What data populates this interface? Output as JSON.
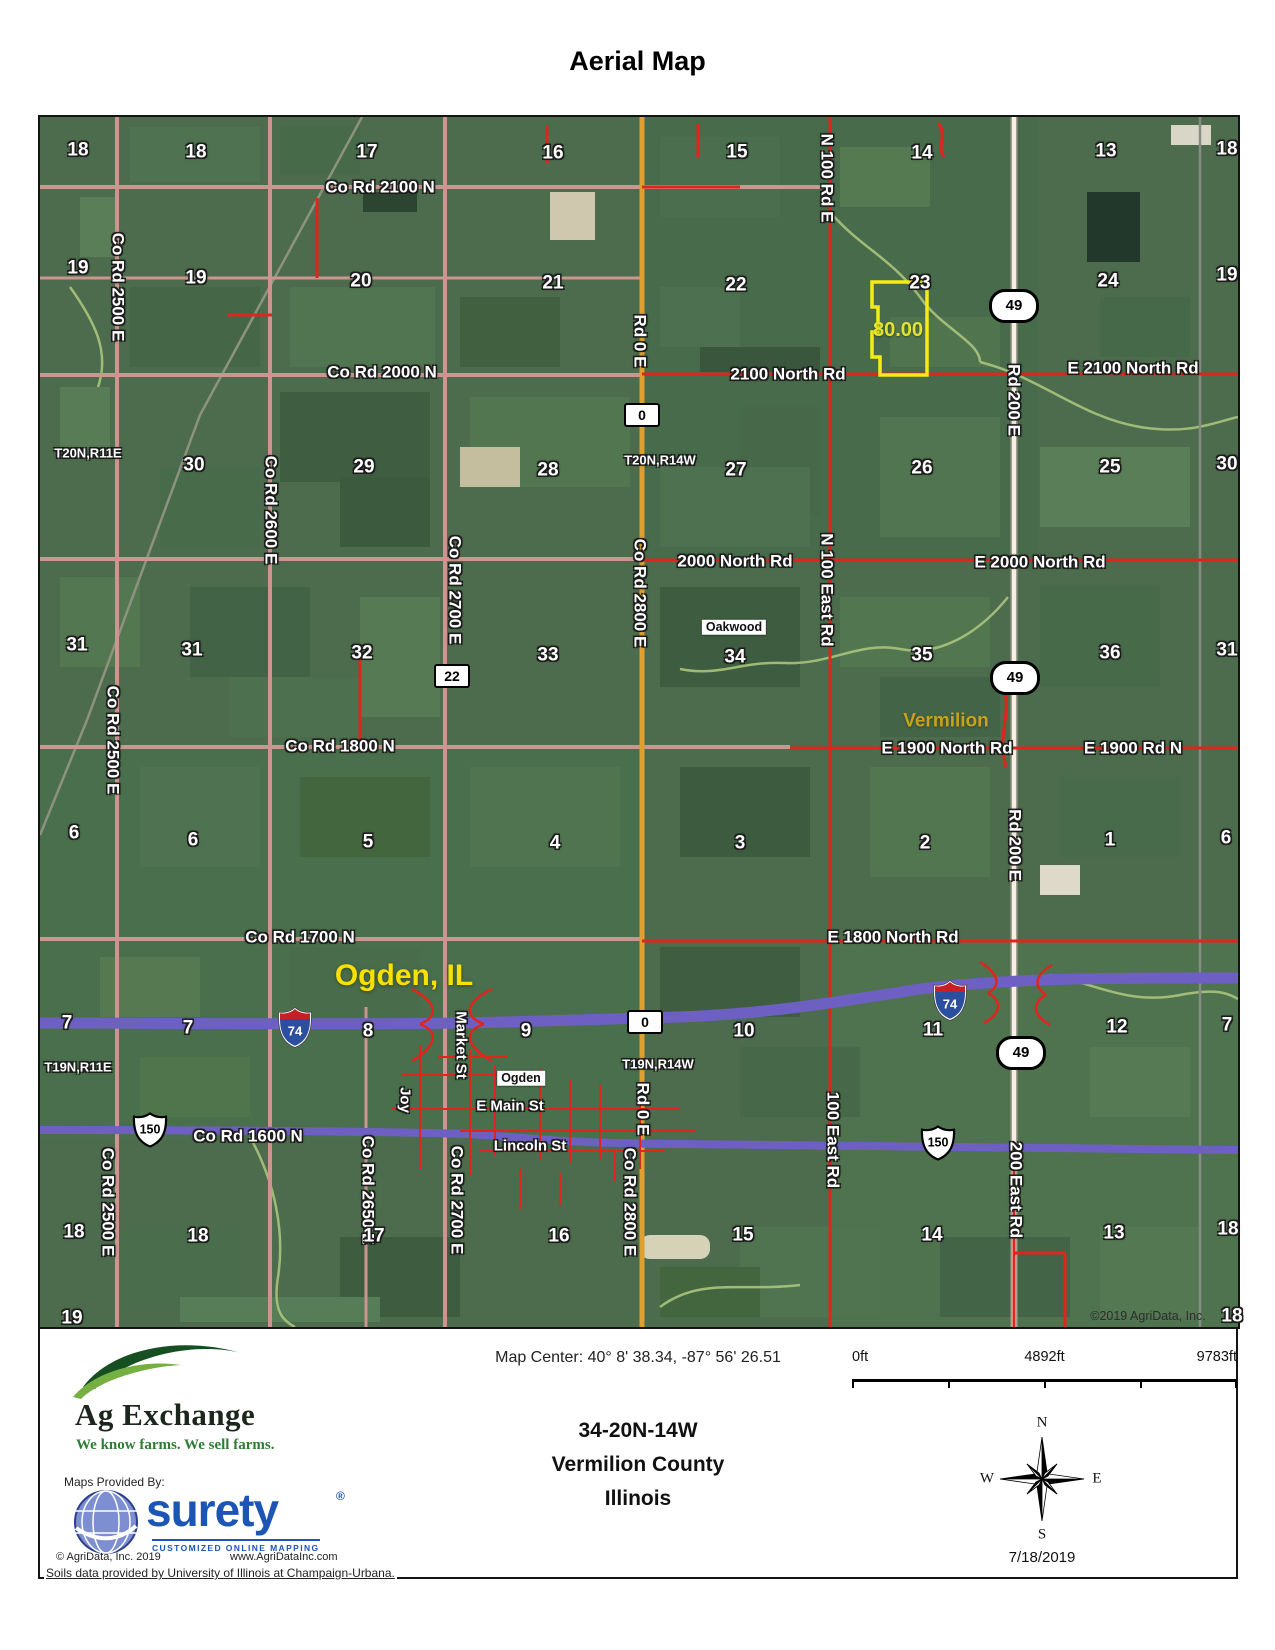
{
  "title": "Aerial Map",
  "map": {
    "copyright": "©2019 AgriData, Inc.",
    "labels": [
      {
        "t": "Co Rd 2100 N",
        "x": 340,
        "y": 70,
        "cls": "road"
      },
      {
        "t": "Co Rd 2000 N",
        "x": 342,
        "y": 255,
        "cls": "road"
      },
      {
        "t": "2100 North Rd",
        "x": 748,
        "y": 257,
        "cls": "road"
      },
      {
        "t": "E 2100 North Rd",
        "x": 1093,
        "y": 251,
        "cls": "road"
      },
      {
        "t": "2000 North Rd",
        "x": 695,
        "y": 444,
        "cls": "road"
      },
      {
        "t": "E 2000 North Rd",
        "x": 1000,
        "y": 445,
        "cls": "road"
      },
      {
        "t": "Co Rd 1800 N",
        "x": 300,
        "y": 629,
        "cls": "road"
      },
      {
        "t": "E 1900 North Rd",
        "x": 907,
        "y": 631,
        "cls": "road"
      },
      {
        "t": "E 1900 Rd N",
        "x": 1093,
        "y": 631,
        "cls": "road"
      },
      {
        "t": "Co Rd 1700 N",
        "x": 260,
        "y": 820,
        "cls": "road"
      },
      {
        "t": "E 1800 North Rd",
        "x": 853,
        "y": 820,
        "cls": "road"
      },
      {
        "t": "Co Rd 1600 N",
        "x": 208,
        "y": 1019,
        "cls": "road"
      },
      {
        "t": "Co Rd 2500 E",
        "x": 78,
        "y": 170,
        "cls": "road",
        "rot": 1
      },
      {
        "t": "Co Rd 2500 E",
        "x": 73,
        "y": 623,
        "cls": "road",
        "rot": 1
      },
      {
        "t": "Co Rd 2500 E",
        "x": 68,
        "y": 1085,
        "cls": "road",
        "rot": 1
      },
      {
        "t": "Co Rd 2600 E",
        "x": 231,
        "y": 393,
        "cls": "road",
        "rot": 1
      },
      {
        "t": "Co Rd 2700 E",
        "x": 415,
        "y": 473,
        "cls": "road",
        "rot": 1
      },
      {
        "t": "Co Rd 2700 E",
        "x": 417,
        "y": 1083,
        "cls": "road",
        "rot": 1
      },
      {
        "t": "Co Rd 2650 E",
        "x": 328,
        "y": 1073,
        "cls": "road",
        "rot": 1
      },
      {
        "t": "Co Rd 2800 E",
        "x": 600,
        "y": 476,
        "cls": "road",
        "rot": 1
      },
      {
        "t": "Co Rd 2800 E",
        "x": 590,
        "y": 1085,
        "cls": "road",
        "rot": 1
      },
      {
        "t": "Rd 0 E",
        "x": 600,
        "y": 224,
        "cls": "road",
        "rot": 1
      },
      {
        "t": "Rd 0 E",
        "x": 603,
        "y": 992,
        "cls": "road",
        "rot": 1
      },
      {
        "t": "N 100 Rd E",
        "x": 787,
        "y": 61,
        "cls": "road",
        "rot": 1
      },
      {
        "t": "N 100 East Rd",
        "x": 787,
        "y": 473,
        "cls": "road",
        "rot": 1
      },
      {
        "t": "100 East Rd",
        "x": 793,
        "y": 1023,
        "cls": "road",
        "rot": 1
      },
      {
        "t": "Rd 200 E",
        "x": 974,
        "y": 283,
        "cls": "road",
        "rot": 1
      },
      {
        "t": "Rd 200 E",
        "x": 975,
        "y": 728,
        "cls": "road",
        "rot": 1
      },
      {
        "t": "200 East Rd",
        "x": 976,
        "y": 1073,
        "cls": "road",
        "rot": 1
      },
      {
        "t": "Market St",
        "x": 421,
        "y": 928,
        "cls": "street",
        "rot": 1
      },
      {
        "t": "Joy",
        "x": 365,
        "y": 983,
        "cls": "street",
        "rot": 1
      },
      {
        "t": "E Main St",
        "x": 470,
        "y": 989,
        "cls": "street"
      },
      {
        "t": "Lincoln St",
        "x": 490,
        "y": 1029,
        "cls": "street"
      },
      {
        "t": "T20N,R11E",
        "x": 48,
        "y": 336,
        "cls": "twp"
      },
      {
        "t": "T20N,R14W",
        "x": 620,
        "y": 343,
        "cls": "twp"
      },
      {
        "t": "T19N,R11E",
        "x": 38,
        "y": 950,
        "cls": "twp"
      },
      {
        "t": "T19N,R14W",
        "x": 618,
        "y": 947,
        "cls": "twp"
      },
      {
        "t": "Oakwood",
        "x": 694,
        "y": 510,
        "cls": "boxed"
      },
      {
        "t": "Ogden",
        "x": 481,
        "y": 961,
        "cls": "boxed"
      },
      {
        "t": "Ogden, IL",
        "x": 364,
        "y": 859,
        "cls": "city"
      },
      {
        "t": "Vermilion",
        "x": 906,
        "y": 604,
        "cls": "verm"
      },
      {
        "t": "80.00",
        "x": 858,
        "y": 213,
        "cls": "acres"
      },
      {
        "t": "©2019 AgriData, Inc.",
        "x": 1108,
        "y": 1199,
        "cls": "copy"
      }
    ],
    "sections": [
      {
        "t": "18",
        "x": 38,
        "y": 33
      },
      {
        "t": "18",
        "x": 156,
        "y": 35
      },
      {
        "t": "17",
        "x": 327,
        "y": 35
      },
      {
        "t": "16",
        "x": 513,
        "y": 36
      },
      {
        "t": "15",
        "x": 697,
        "y": 35
      },
      {
        "t": "14",
        "x": 882,
        "y": 36
      },
      {
        "t": "13",
        "x": 1066,
        "y": 34
      },
      {
        "t": "18",
        "x": 1187,
        "y": 32
      },
      {
        "t": "19",
        "x": 38,
        "y": 151
      },
      {
        "t": "19",
        "x": 156,
        "y": 161
      },
      {
        "t": "20",
        "x": 321,
        "y": 164
      },
      {
        "t": "21",
        "x": 513,
        "y": 166
      },
      {
        "t": "22",
        "x": 696,
        "y": 168
      },
      {
        "t": "23",
        "x": 880,
        "y": 166
      },
      {
        "t": "24",
        "x": 1068,
        "y": 164
      },
      {
        "t": "19",
        "x": 1187,
        "y": 158
      },
      {
        "t": "30",
        "x": 154,
        "y": 348
      },
      {
        "t": "29",
        "x": 324,
        "y": 350
      },
      {
        "t": "28",
        "x": 508,
        "y": 353
      },
      {
        "t": "27",
        "x": 696,
        "y": 353
      },
      {
        "t": "26",
        "x": 882,
        "y": 351
      },
      {
        "t": "25",
        "x": 1070,
        "y": 350
      },
      {
        "t": "30",
        "x": 1187,
        "y": 347
      },
      {
        "t": "31",
        "x": 37,
        "y": 528
      },
      {
        "t": "31",
        "x": 152,
        "y": 533
      },
      {
        "t": "32",
        "x": 322,
        "y": 536
      },
      {
        "t": "33",
        "x": 508,
        "y": 538
      },
      {
        "t": "34",
        "x": 695,
        "y": 540
      },
      {
        "t": "35",
        "x": 882,
        "y": 538
      },
      {
        "t": "36",
        "x": 1070,
        "y": 536
      },
      {
        "t": "31",
        "x": 1187,
        "y": 533
      },
      {
        "t": "6",
        "x": 34,
        "y": 716
      },
      {
        "t": "6",
        "x": 153,
        "y": 723
      },
      {
        "t": "5",
        "x": 328,
        "y": 725
      },
      {
        "t": "4",
        "x": 515,
        "y": 726
      },
      {
        "t": "3",
        "x": 700,
        "y": 726
      },
      {
        "t": "2",
        "x": 885,
        "y": 726
      },
      {
        "t": "1",
        "x": 1070,
        "y": 723
      },
      {
        "t": "6",
        "x": 1186,
        "y": 721
      },
      {
        "t": "7",
        "x": 27,
        "y": 906
      },
      {
        "t": "7",
        "x": 148,
        "y": 911
      },
      {
        "t": "8",
        "x": 328,
        "y": 914
      },
      {
        "t": "9",
        "x": 486,
        "y": 914
      },
      {
        "t": "10",
        "x": 704,
        "y": 914
      },
      {
        "t": "11",
        "x": 893,
        "y": 913
      },
      {
        "t": "12",
        "x": 1077,
        "y": 910
      },
      {
        "t": "7",
        "x": 1187,
        "y": 908
      },
      {
        "t": "18",
        "x": 34,
        "y": 1115
      },
      {
        "t": "18",
        "x": 158,
        "y": 1119
      },
      {
        "t": "17",
        "x": 334,
        "y": 1119
      },
      {
        "t": "16",
        "x": 519,
        "y": 1119
      },
      {
        "t": "15",
        "x": 703,
        "y": 1118
      },
      {
        "t": "14",
        "x": 892,
        "y": 1118
      },
      {
        "t": "13",
        "x": 1074,
        "y": 1116
      },
      {
        "t": "18",
        "x": 1188,
        "y": 1112
      },
      {
        "t": "19",
        "x": 32,
        "y": 1201
      },
      {
        "t": "18",
        "x": 1192,
        "y": 1199
      }
    ],
    "shields": [
      {
        "k": "oval",
        "t": "49",
        "x": 974,
        "y": 189
      },
      {
        "k": "oval",
        "t": "49",
        "x": 975,
        "y": 561
      },
      {
        "k": "oval",
        "t": "49",
        "x": 981,
        "y": 936
      },
      {
        "k": "box",
        "t": "0",
        "x": 602,
        "y": 298
      },
      {
        "k": "box",
        "t": "0",
        "x": 605,
        "y": 905
      },
      {
        "k": "box",
        "t": "22",
        "x": 412,
        "y": 559
      },
      {
        "k": "i",
        "t": "74",
        "x": 255,
        "y": 913
      },
      {
        "k": "i",
        "t": "74",
        "x": 910,
        "y": 886
      },
      {
        "k": "us",
        "t": "150",
        "x": 110,
        "y": 1015
      },
      {
        "k": "us",
        "t": "150",
        "x": 898,
        "y": 1028
      }
    ]
  },
  "footer": {
    "map_center": "Map Center: 40° 8' 38.34,  -87° 56' 26.51",
    "scale": [
      "0ft",
      "4892ft",
      "9783ft"
    ],
    "property_id": "34-20N-14W",
    "county": "Vermilion County",
    "state": "Illinois",
    "brand": "Ag Exchange",
    "tagline": "We know farms. We sell farms.",
    "maps_by": "Maps Provided By:",
    "surety": "surety",
    "surety_reg": "®",
    "surety_tag": "CUSTOMIZED ONLINE MAPPING",
    "agridata_copy": "© AgriData, Inc. 2019",
    "agridata_url": "www.AgriDataInc.com",
    "date": "7/18/2019",
    "compass": {
      "n": "N",
      "e": "E",
      "s": "S",
      "w": "W"
    },
    "soils": "Soils data provided by University of Illinois at Champaign-Urbana."
  }
}
